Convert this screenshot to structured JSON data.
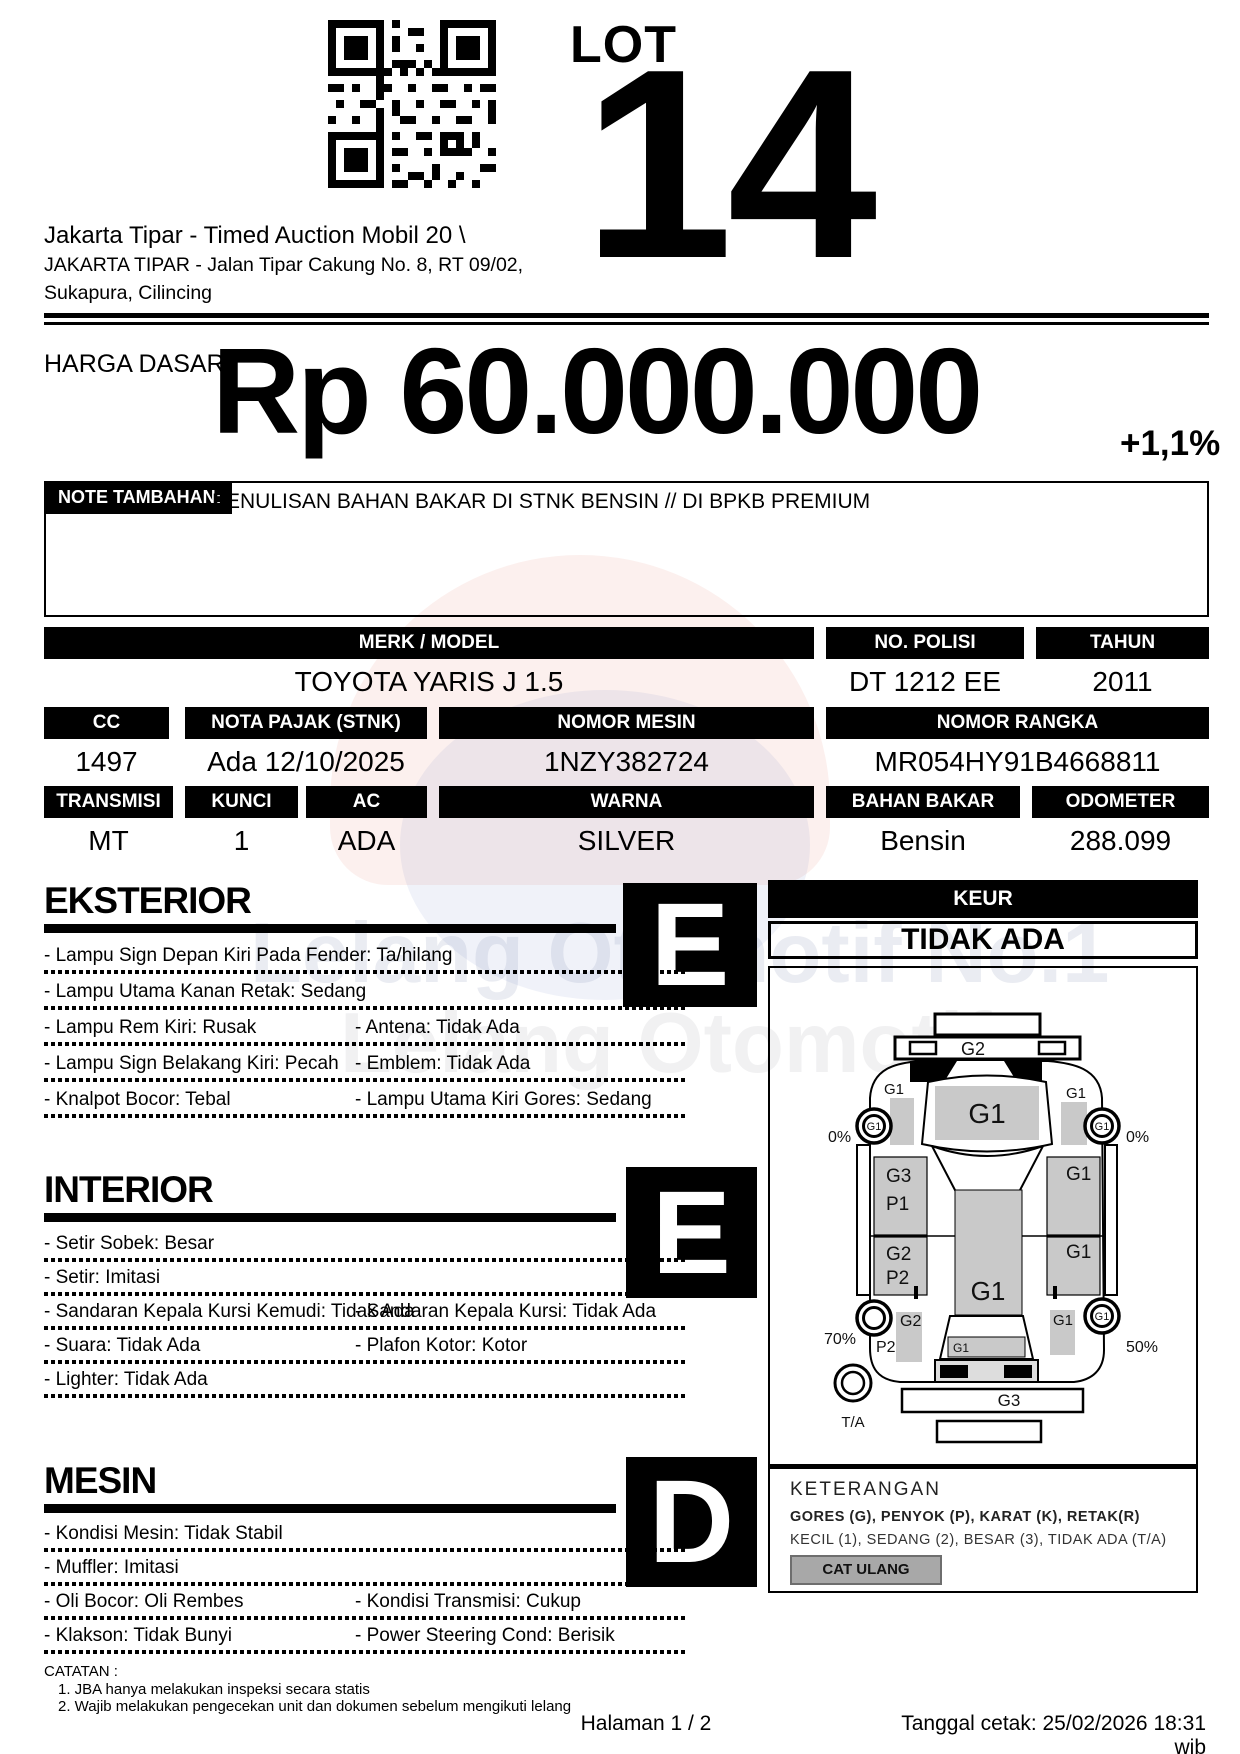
{
  "header": {
    "lot_label": "LOT",
    "lot_number": "14",
    "auction_title": "Jakarta Tipar - Timed Auction Mobil 20 \\",
    "address1": "JAKARTA TIPAR - Jalan Tipar Cakung No. 8, RT 09/02,",
    "address2": "Sukapura, Cilincing"
  },
  "price": {
    "label": "HARGA DASAR :",
    "amount": "Rp 60.000.000",
    "change": "+1,1%"
  },
  "note": {
    "label": "NOTE TAMBAHAN:",
    "text": "PENULISAN BAHAN BAKAR DI STNK BENSIN // DI BPKB PREMIUM"
  },
  "vehicle": {
    "merk_model": {
      "label": "MERK / MODEL",
      "value": "TOYOTA YARIS J 1.5"
    },
    "no_polisi": {
      "label": "NO. POLISI",
      "value": "DT 1212 EE"
    },
    "tahun": {
      "label": "TAHUN",
      "value": "2011"
    },
    "cc": {
      "label": "CC",
      "value": "1497"
    },
    "nota_pajak": {
      "label": "NOTA PAJAK (STNK)",
      "value": "Ada 12/10/2025"
    },
    "nomor_mesin": {
      "label": "NOMOR MESIN",
      "value": "1NZY382724"
    },
    "nomor_rangka": {
      "label": "NOMOR RANGKA",
      "value": "MR054HY91B4668811"
    },
    "transmisi": {
      "label": "TRANSMISI",
      "value": "MT"
    },
    "kunci": {
      "label": "KUNCI",
      "value": "1"
    },
    "ac": {
      "label": "AC",
      "value": "ADA"
    },
    "warna": {
      "label": "WARNA",
      "value": "SILVER"
    },
    "bahan_bakar": {
      "label": "BAHAN BAKAR",
      "value": "Bensin"
    },
    "odometer": {
      "label": "ODOMETER",
      "value": "288.099"
    }
  },
  "sections": {
    "eksterior": {
      "title": "EKSTERIOR",
      "grade": "E",
      "items": [
        {
          "left": "- Lampu Sign Depan Kiri Pada Fender: Ta/hilang",
          "right": ""
        },
        {
          "left": "- Lampu Utama Kanan Retak: Sedang",
          "right": ""
        },
        {
          "left": "- Lampu Rem Kiri: Rusak",
          "right": "- Antena: Tidak Ada"
        },
        {
          "left": "- Lampu Sign Belakang Kiri: Pecah",
          "right": "- Emblem: Tidak Ada"
        },
        {
          "left": "- Knalpot Bocor: Tebal",
          "right": "- Lampu Utama Kiri Gores: Sedang"
        }
      ]
    },
    "interior": {
      "title": "INTERIOR",
      "grade": "E",
      "items": [
        {
          "left": "- Setir Sobek: Besar",
          "right": ""
        },
        {
          "left": "- Setir: Imitasi",
          "right": ""
        },
        {
          "left": "- Sandaran Kepala Kursi Kemudi: Tidak Ada",
          "right": "- Sandaran Kepala Kursi: Tidak Ada"
        },
        {
          "left": "- Suara: Tidak Ada",
          "right": "- Plafon Kotor: Kotor"
        },
        {
          "left": "- Lighter: Tidak Ada",
          "right": ""
        }
      ]
    },
    "mesin": {
      "title": "MESIN",
      "grade": "D",
      "items": [
        {
          "left": "- Kondisi Mesin: Tidak Stabil",
          "right": ""
        },
        {
          "left": "- Muffler: Imitasi",
          "right": ""
        },
        {
          "left": "- Oli Bocor: Oli Rembes",
          "right": "- Kondisi Transmisi: Cukup"
        },
        {
          "left": "- Klakson: Tidak Bunyi",
          "right": "- Power Steering Cond: Berisik"
        }
      ]
    }
  },
  "keur": {
    "label": "KEUR",
    "value": "TIDAK ADA"
  },
  "diagram": {
    "front_bumper_grade": "G2",
    "hood_grade": "G1",
    "left_front_fender_grade": "G1",
    "left_front_wheel_grade": "G1",
    "right_front_fender_grade": "G1",
    "right_front_wheel_grade": "G1",
    "front_left_tread": "0%",
    "front_right_tread": "0%",
    "left_front_door_grade": "G3",
    "left_front_door_grade2": "P1",
    "left_rear_door_grade": "G2",
    "left_rear_door_grade2": "P2",
    "roof_grade": "G1",
    "right_front_door_grade": "G1",
    "right_rear_door_grade": "G1",
    "left_rear_quarter_grade": "G2",
    "left_rear_quarter_grade2": "P2",
    "rear_left_tread": "70%",
    "right_rear_quarter_grade": "G1",
    "right_rear_wheel_grade": "G1",
    "rear_right_tread": "50%",
    "rear_glass_grade": "G1",
    "rear_bumper_grade": "G3",
    "spare_tire": "T/A"
  },
  "keterangan": {
    "title": "KETERANGAN",
    "line1": "GORES (G), PENYOK (P), KARAT (K), RETAK(R)",
    "line2": "KECIL (1), SEDANG (2), BESAR (3), TIDAK ADA (T/A)",
    "cat_ulang": "CAT ULANG"
  },
  "catatan": {
    "label": "CATATAN :",
    "lines": [
      "1. JBA hanya melakukan inspeksi secara statis",
      "2. Wajib melakukan pengecekan unit dan dokumen sebelum mengikuti lelang"
    ]
  },
  "footer": {
    "page": "Halaman 1 / 2",
    "printed": "Tanggal cetak: 25/02/2026 18:31 wib"
  },
  "watermark": {
    "line1": "Lelang Otomotif No.1",
    "line2": "Lelang Otomotif"
  },
  "colors": {
    "panel_gray": "#c9c9c9",
    "button_gray": "#a8a8a8",
    "black": "#000000"
  }
}
